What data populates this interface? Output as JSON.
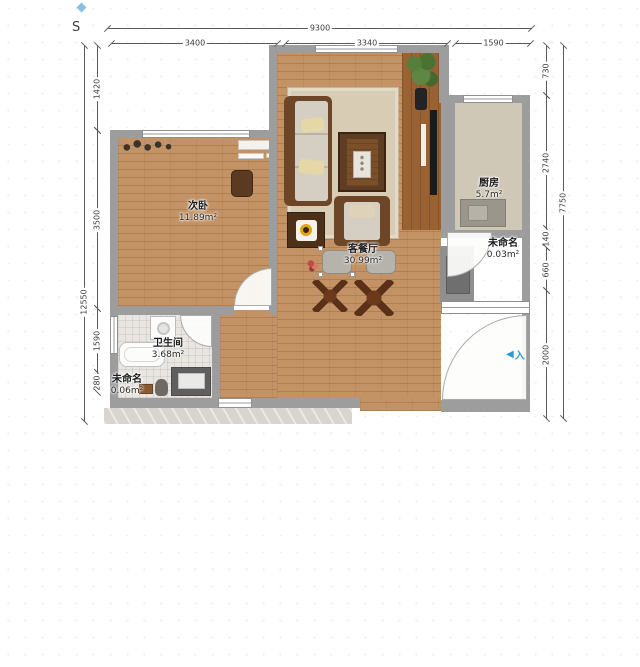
{
  "compass": {
    "label": "S"
  },
  "dims": {
    "top_total": "9300",
    "top_seg": [
      "3400",
      "3340",
      "1590"
    ],
    "left_total": "12550",
    "left_seg": [
      "1420",
      "3500",
      "1590",
      "280"
    ],
    "right_total": "7750",
    "right_seg": [
      "730",
      "2740",
      "140",
      "660",
      "2000"
    ]
  },
  "rooms": {
    "bedroom": {
      "name": "次卧",
      "area": "11.89m²"
    },
    "living": {
      "name": "客餐厅",
      "area": "30.99m²"
    },
    "kitchen": {
      "name": "厨房",
      "area": "5.7m²"
    },
    "flue": {
      "name": "未命名",
      "area": "0.03m²"
    },
    "bath": {
      "name": "卫生间",
      "area": "3.68m²"
    },
    "niche": {
      "name": "未命名",
      "area": "0.06m²"
    }
  },
  "entrance": {
    "label": "入",
    "arrow": "◀"
  },
  "colors": {
    "wall": "#9d9d9d",
    "wood": "#c49365",
    "kitchen_floor": "#cfc8b7",
    "tile": "#e9e6e1",
    "marble": "#d8d4cf",
    "accent_blue": "#2a9ad2",
    "ring_yellow": "#e2a40f"
  }
}
